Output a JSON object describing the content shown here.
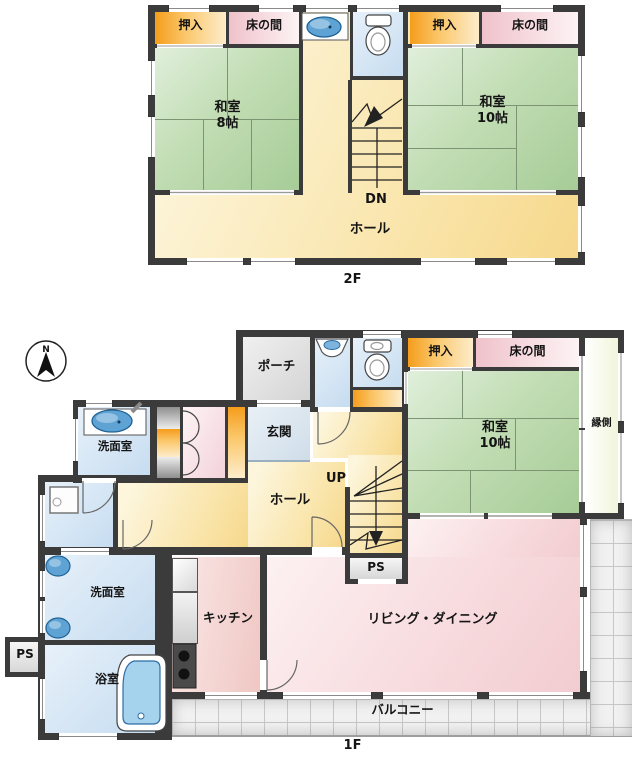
{
  "title": "間取り図",
  "compass": {
    "n": "N"
  },
  "colors": {
    "wall": "#3b3b3b",
    "tatami_green": "#a6cc97",
    "closet_orange": "#f59d1c",
    "tokonoma_pink": "#efc2cb",
    "water_blue": "#c6dcf0",
    "hall_cream": "#f6d88c",
    "living_pink": "#f2ccd1",
    "balcony_gray": "#f1f1f1",
    "fixture_blue": "#5ea3d4"
  },
  "floor2": {
    "floor_label": "2F",
    "oshiire_left": "押入",
    "tokonoma_left": "床の間",
    "washitsu8_name": "和室",
    "washitsu8_size": "8帖",
    "oshiire_right": "押入",
    "tokonoma_right": "床の間",
    "washitsu10_name": "和室",
    "washitsu10_size": "10帖",
    "stairs": "DN",
    "hall": "ホール"
  },
  "floor1": {
    "floor_label": "1F",
    "porch": "ポーチ",
    "genkan": "玄関",
    "washroom_upper": "洗面室",
    "washroom_lower": "洗面室",
    "bathroom": "浴室",
    "kitchen": "キッチン",
    "living": "リビング・ダイニング",
    "hall": "ホール",
    "stairs": "UP",
    "ps_stairs": "PS",
    "ps_left": "PS",
    "oshiire": "押入",
    "tokonoma": "床の間",
    "washitsu10_name": "和室",
    "washitsu10_size": "10帖",
    "engawa": "縁側",
    "balcony": "バルコニー"
  }
}
